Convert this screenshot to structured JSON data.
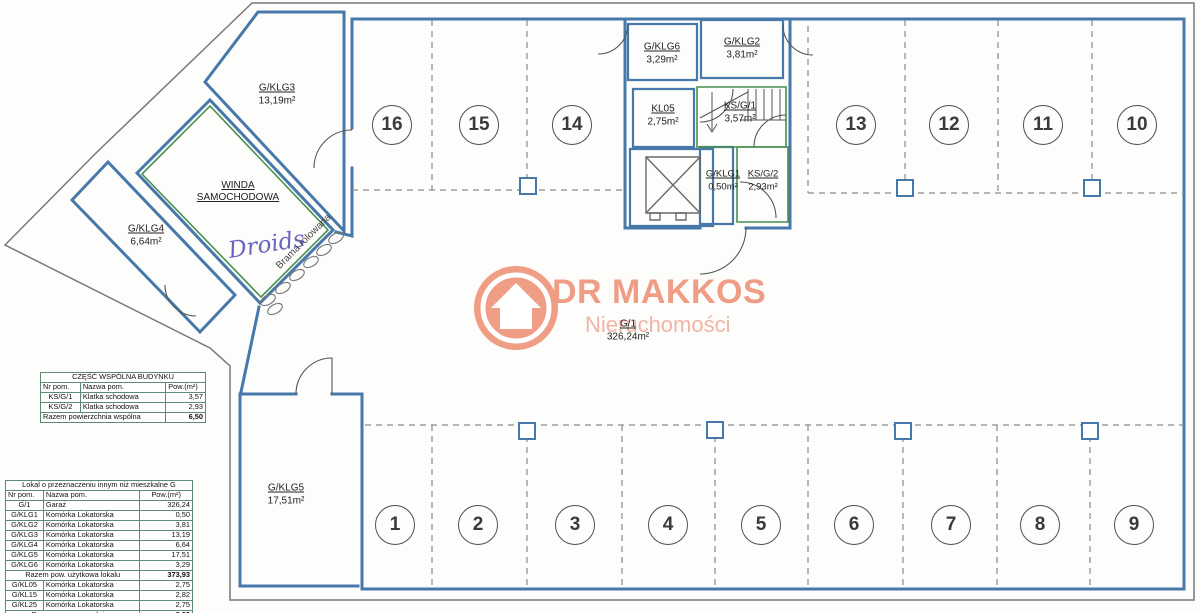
{
  "logo": {
    "title": "DR MAKKOS",
    "subtitle": "Nieruchomości",
    "brand_color": "#ef9d85",
    "subtitle_color": "#f2b5a4"
  },
  "annotations": {
    "handwriting": "Droids",
    "gate_label": "Brama rolowana"
  },
  "rooms": {
    "g1": {
      "id": "G/1",
      "area": "326,24m²"
    },
    "gklg1": {
      "id": "G/KLG1",
      "area": "0,50m²"
    },
    "gklg2": {
      "id": "G/KLG2",
      "area": "3,81m²"
    },
    "gklg3": {
      "id": "G/KLG3",
      "area": "13,19m²"
    },
    "gklg4": {
      "id": "G/KLG4",
      "area": "6,64m²"
    },
    "gklg5": {
      "id": "G/KLG5",
      "area": "17,51m²"
    },
    "gklg6": {
      "id": "G/KLG6",
      "area": "3,29m²"
    },
    "kl05": {
      "id": "KL05",
      "area": "2,75m²"
    },
    "ksg1": {
      "id": "KS/G/1",
      "area": "3,57m²"
    },
    "ksg2": {
      "id": "KS/G/2",
      "area": "2,93m²"
    },
    "winda": {
      "line1": "WINDA",
      "line2": "SAMOCHODOWA"
    }
  },
  "parking": {
    "spots": [
      "1",
      "2",
      "3",
      "4",
      "5",
      "6",
      "7",
      "8",
      "9",
      "10",
      "11",
      "12",
      "13",
      "14",
      "15",
      "16"
    ]
  },
  "tables": {
    "common": {
      "title": "CZĘŚĆ WSPÓLNA BUDYNKU",
      "headers": [
        "Nr pom.",
        "Nazwa pom.",
        "Pow.(m²)"
      ],
      "rows": [
        {
          "nr": "KS/G/1",
          "name": "Klatka schodowa",
          "area": "3,57"
        },
        {
          "nr": "KS/G/2",
          "name": "Klatka schodowa",
          "area": "2,93"
        }
      ],
      "total_label": "Razem powierzchnia wspólna",
      "total_value": "6,50"
    },
    "lokal": {
      "title": "Lokal o przeznaczeniu innym niż mieszkalne G",
      "headers": [
        "Nr pom.",
        "Nazwa pom.",
        "Pow.(m²)"
      ],
      "rows": [
        {
          "nr": "G/1",
          "name": "Garaż",
          "area": "326,24"
        },
        {
          "nr": "G/KLG1",
          "name": "Komórka Lokatorska",
          "area": "0,50"
        },
        {
          "nr": "G/KLG2",
          "name": "Komórka Lokatorska",
          "area": "3,81"
        },
        {
          "nr": "G/KLG3",
          "name": "Komórka Lokatorska",
          "area": "13,19"
        },
        {
          "nr": "G/KLG4",
          "name": "Komórka Lokatorska",
          "area": "6,64"
        },
        {
          "nr": "G/KLG5",
          "name": "Komórka Lokatorska",
          "area": "17,51"
        },
        {
          "nr": "G/KLG6",
          "name": "Komórka Lokatorska",
          "area": "3,29"
        }
      ],
      "subtotal_label": "Razem pow. użytkowa lokalu",
      "subtotal_value": "373,93",
      "extra_rows": [
        {
          "nr": "G/KL05",
          "name": "Komórka Lokatorska",
          "area": "2,75"
        },
        {
          "nr": "G/KL15",
          "name": "Komórka Lokatorska",
          "area": "2,82"
        },
        {
          "nr": "G/KL25",
          "name": "Komórka Lokatorska",
          "area": "2,75"
        }
      ],
      "total_label": "Razem pow. przynależna",
      "total_value": "8,32"
    }
  }
}
